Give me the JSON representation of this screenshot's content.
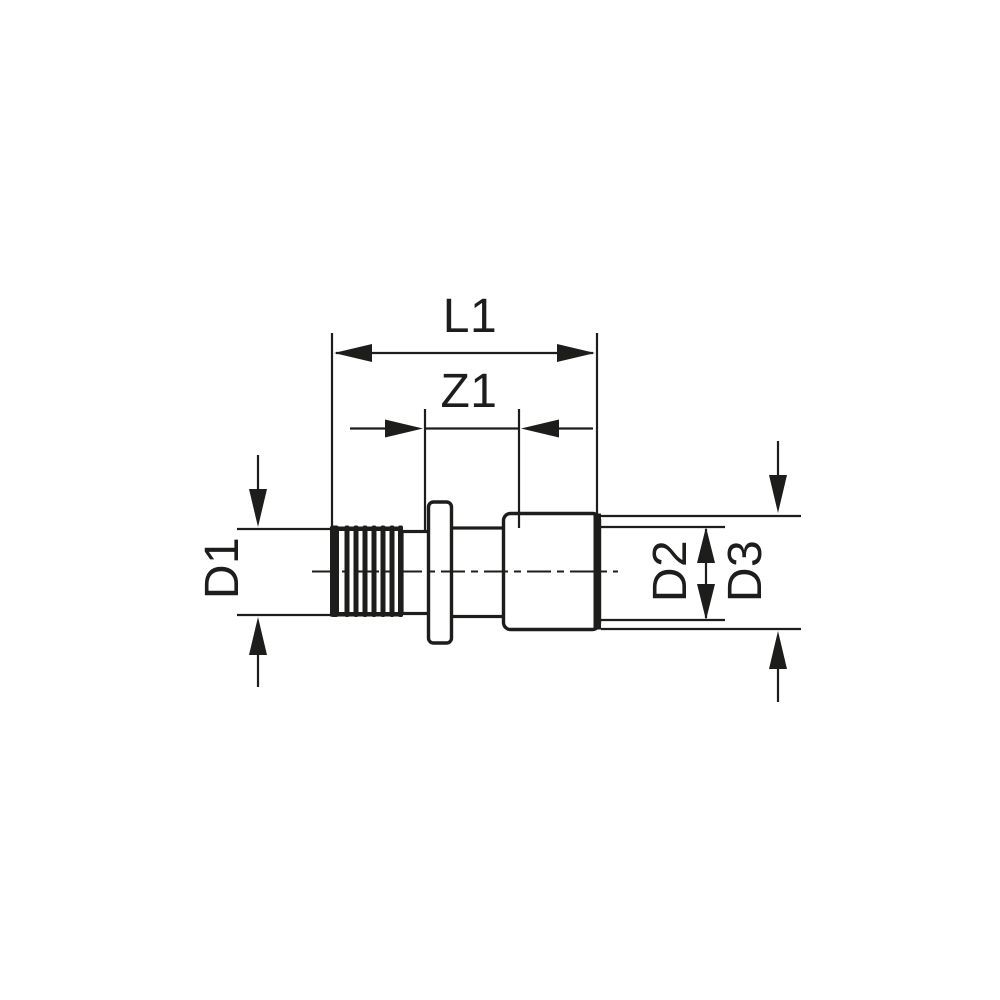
{
  "drawing": {
    "background": "#ffffff",
    "ink": "#1d1d1b",
    "labels": {
      "l1": "L1",
      "z1": "Z1",
      "d1": "D1",
      "d2": "D2",
      "d3": "D3"
    }
  }
}
